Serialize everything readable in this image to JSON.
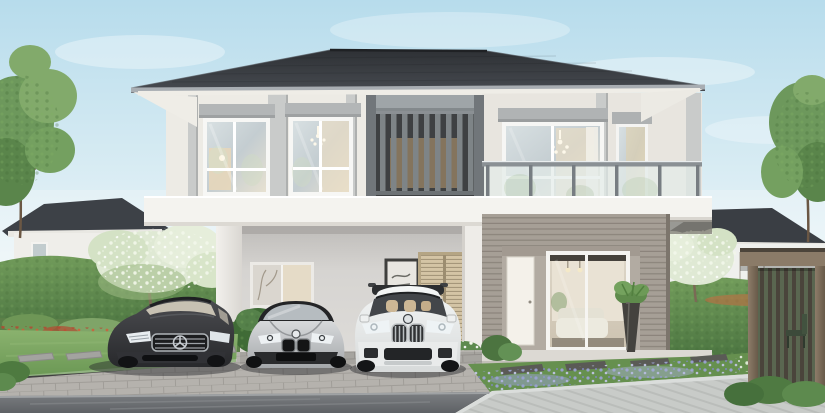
{
  "scene": {
    "type": "architectural-exterior-rendering",
    "description": "Photorealistic daytime rendering of a modern two-storey detached house with a double carport, a glass-railing balcony, a vertical-louvre feature screen and landscaped gardens; a dark grey sedan, a silver coupe and a white SUV are parked in front.",
    "labels": {
      "house": "Two-storey detached house",
      "roof": "Dark grey hipped roof",
      "balcony": "Glass-railing balcony",
      "slat_screen": "Vertical louvre feature screen",
      "carport": "Double carport",
      "carport_window": "Carport back-wall window",
      "wall_art": "Framed wall art in carport",
      "louver_door": "Timber louvre utility doors",
      "entry_door": "White entrance door",
      "living_window": "Living room sliding glass window",
      "potted_plant": "Potted plant in dark vase",
      "car_dark_sedan": "Dark grey luxury sedan",
      "car_silver_coupe": "Silver sports coupe",
      "car_white_suv": "White compact SUV",
      "pergola": "Timber garden pergola",
      "bg_house_left": "Neighbouring house (left)",
      "bg_house_right": "Neighbouring house (right)",
      "driveway": "Grey block-paved driveway",
      "road": "Asphalt road",
      "sidewalk": "Concrete sidewalk",
      "lawn": "Front lawn with stepping stones",
      "flower_bed_left": "Flower bed with red shrubs",
      "flower_bed_right": "Lavender flower border",
      "hedge": "Clipped green hedge",
      "tree": "Garden tree",
      "flowering_tree": "White-blossom tree",
      "sky": "Clear blue sky with soft clouds"
    }
  },
  "colors": {
    "sky_top": "#b7dcec",
    "sky_horizon": "#eef6f8",
    "roof": "#2e3135",
    "roof_light": "#474b51",
    "fascia": "#efede7",
    "wall_upper": "#edebe5",
    "wall_right": "#e8e5df",
    "slab": "#f4f3ef",
    "carport_wall": "#d6d4d1",
    "recessed_wall": "#b2aba2",
    "cladding": "#a69f96",
    "cladding_dark": "#8b847b",
    "louver_tan": "#d4c4a5",
    "door_white": "#f4f1ea",
    "glass_warm": "#e9ddc4",
    "railing_metal": "#8a9094",
    "lawn": "#7aa55f",
    "garden": "#66904f",
    "hedge": "#4a7340",
    "hedge_light": "#729c5b",
    "blossom": "#f2f7ea",
    "flower_red": "#b34a32",
    "flower_purple": "#9aa2d2",
    "pavers": "#b5b2ad",
    "sidewalk": "#c8cbc8",
    "road": "#7d8083",
    "road_dark": "#5e6165",
    "stone": "#a3a3a0",
    "pergola_wood": "#8b7b68",
    "pergola_dark": "#4c443a",
    "car_dark": "#28292c",
    "car_dark_highlight": "#4c4d51",
    "car_silver": "#d7d9db",
    "car_silver_shadow": "#a4a7aa",
    "car_white": "#f4f6f6",
    "car_white_shadow": "#d7dada"
  }
}
